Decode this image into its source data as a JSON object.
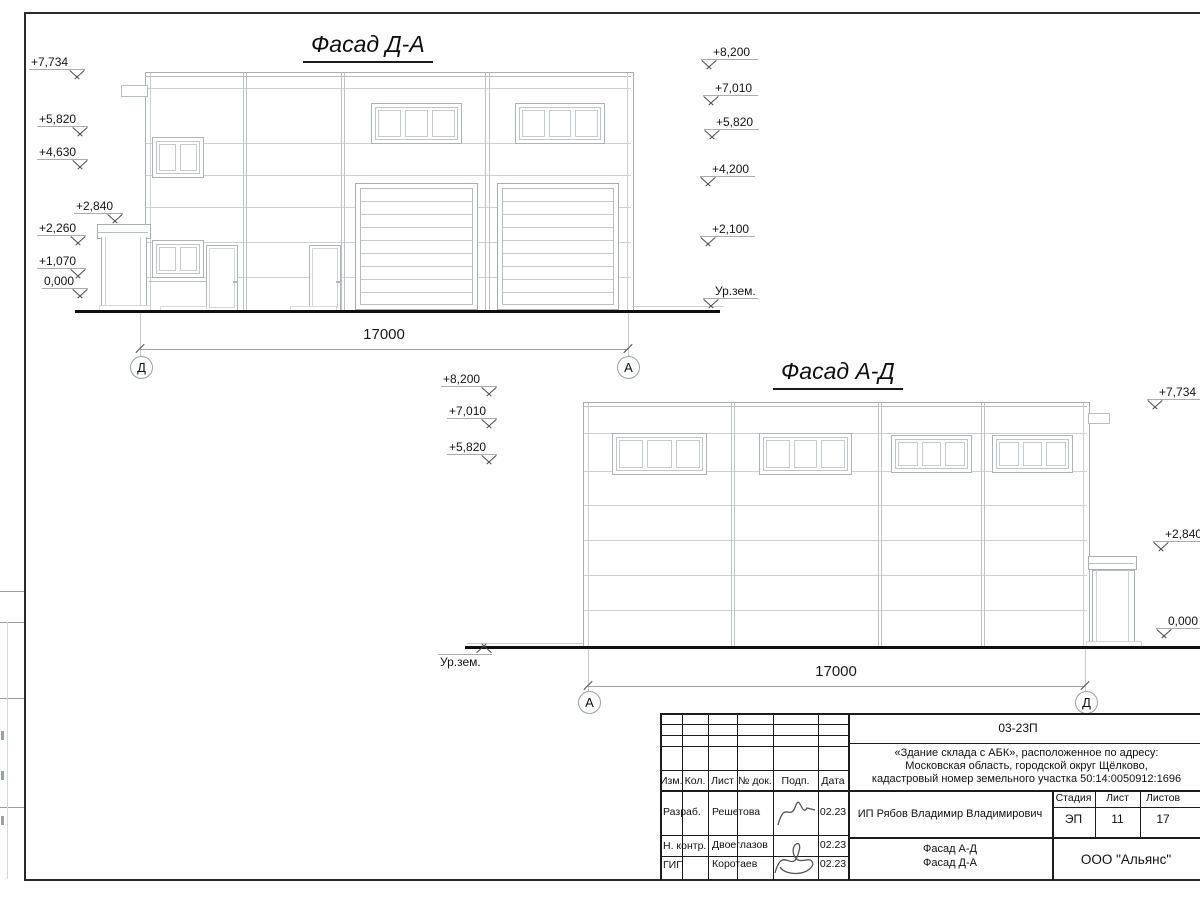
{
  "facade_da": {
    "title": "Фасад Д-А",
    "dim": "17000",
    "axis_left": "Д",
    "axis_right": "А",
    "marks_left": [
      "+7,734",
      "+5,820",
      "+4,630",
      "+2,840",
      "+2,260",
      "+1,070",
      "0,000"
    ],
    "marks_right": [
      "+8,200",
      "+7,010",
      "+5,820",
      "+4,200",
      "+2,100",
      "Ур.зем."
    ]
  },
  "facade_ad": {
    "title": "Фасад А-Д",
    "dim": "17000",
    "axis_left": "А",
    "axis_right": "Д",
    "marks_left": [
      "+8,200",
      "+7,010",
      "+5,820",
      "Ур.зем."
    ],
    "marks_right": [
      "+7,734",
      "+2,840",
      "0,000"
    ]
  },
  "titleblock": {
    "code": "03-23П",
    "address_line1": "«Здание склада с АБК», расположенное по адресу:",
    "address_line2": "Московская область, городской округ Щёлково,",
    "address_line3": "кадастровый номер земельного участка 50:14:0050912:1696",
    "headers": {
      "izm": "Изм.",
      "kol": "Кол.",
      "list": "Лист",
      "doc": "№ док.",
      "podp": "Подп.",
      "data": "Дата"
    },
    "rows": [
      {
        "role": "Разраб.",
        "name": "Решетова",
        "date": "02.23"
      },
      {
        "role": "Н. контр.",
        "name": "Двоеглазов",
        "date": "02.23"
      },
      {
        "role": "ГИП",
        "name": "Коротаев",
        "date": "02.23"
      }
    ],
    "client": "ИП Рябов Владимир Владимирович",
    "stage_label": "Стадия",
    "sheet_label": "Лист",
    "sheets_label": "Листов",
    "stage": "ЭП",
    "sheet": "11",
    "sheets": "17",
    "sheet_name_line1": "Фасад А-Д",
    "sheet_name_line2": "Фасад Д-А",
    "org": "ООО \"Альянс\""
  }
}
